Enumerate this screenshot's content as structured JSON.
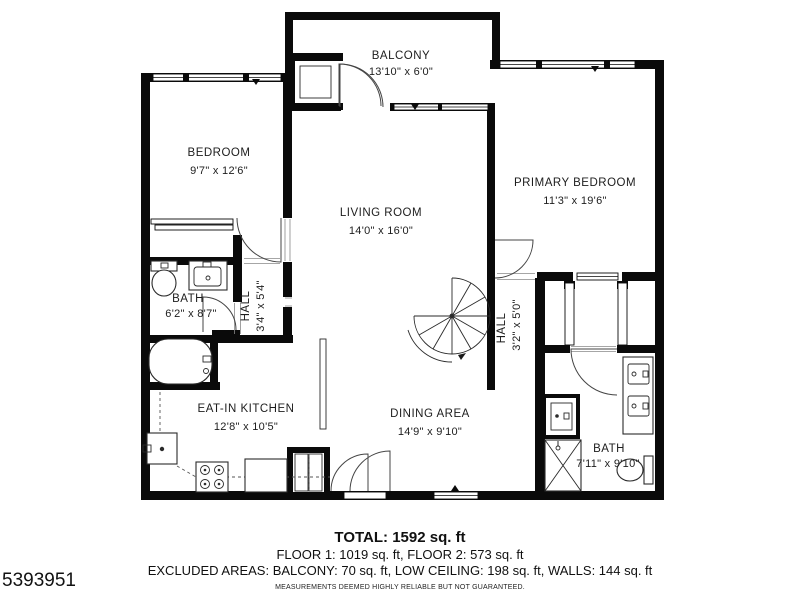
{
  "colors": {
    "wall": "#0a0a0a",
    "line": "#2a2a2a",
    "background": "#ffffff"
  },
  "rooms": {
    "balcony": {
      "name": "BALCONY",
      "dims": "13'10\" x 6'0\""
    },
    "bedroom": {
      "name": "BEDROOM",
      "dims": "9'7\" x 12'6\""
    },
    "living_room": {
      "name": "LIVING ROOM",
      "dims": "14'0\" x 16'0\""
    },
    "primary_bedroom": {
      "name": "PRIMARY BEDROOM",
      "dims": "11'3\" x 19'6\""
    },
    "bath_left": {
      "name": "BATH",
      "dims": "6'2\" x 8'7\""
    },
    "hall_left": {
      "name": "HALL",
      "dims": "3'4\" x 5'4\""
    },
    "hall_right": {
      "name": "HALL",
      "dims": "3'2\" x 5'0\""
    },
    "kitchen": {
      "name": "EAT-IN KITCHEN",
      "dims": "12'8\" x 10'5\""
    },
    "dining": {
      "name": "DINING AREA",
      "dims": "14'9\" x 9'10\""
    },
    "bath_right": {
      "name": "BATH",
      "dims": "7'11\" x 9'10\""
    }
  },
  "footer": {
    "total": "TOTAL: 1592 sq. ft",
    "floors": "FLOOR 1: 1019 sq. ft, FLOOR 2: 573 sq. ft",
    "excluded": "EXCLUDED AREAS: BALCONY: 70 sq. ft, LOW CEILING: 198 sq. ft, WALLS: 144 sq. ft",
    "disclaimer": "MEASUREMENTS DEEMED HIGHLY RELIABLE BUT NOT GUARANTEED.",
    "listing_id": "5393951"
  }
}
